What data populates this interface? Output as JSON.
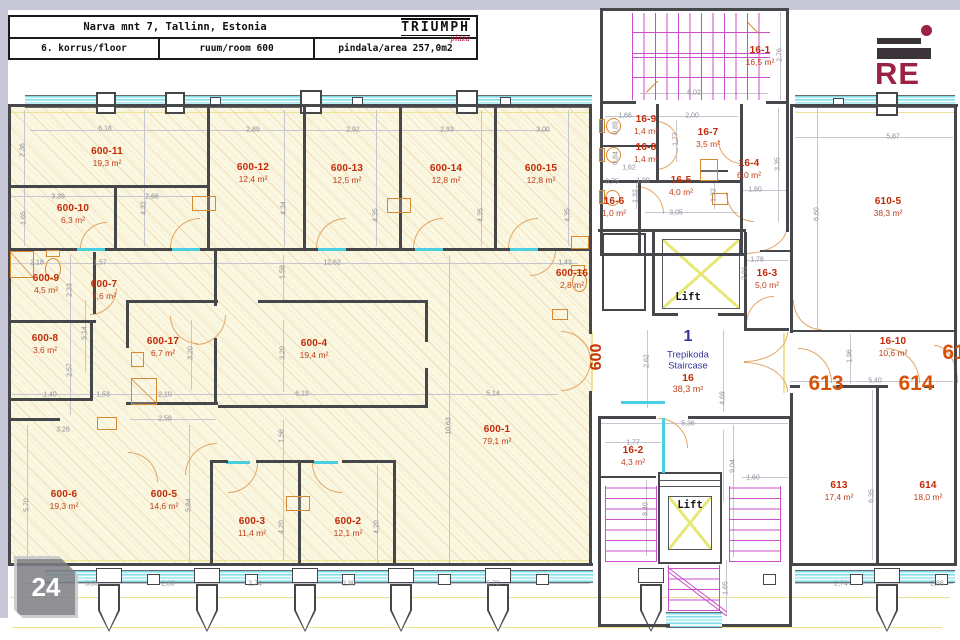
{
  "page": {
    "number": "24"
  },
  "title_block": {
    "address": "Narva mnt 7, Tallinn, Estonia",
    "floor": "6. korrus/floor",
    "room": "ruum/room 600",
    "area": "pindala/area 257,0m2",
    "brand_name": "TRIUMPH",
    "brand_sub": "plaza"
  },
  "logo": {
    "text": "RE"
  },
  "colors": {
    "room_label": "#c22a06",
    "room_area": "#bf3f1c",
    "door_label": "#d85207",
    "dimension": "#8d8d99",
    "stair_blue": "#34349c",
    "hatch_base": "#faf7e3",
    "window_cyan": "#7edde9",
    "stair_magenta": "#ca4fca",
    "lift_yellow": "#e7e776",
    "wall": "#45474b",
    "brand_red": "#c01a3c",
    "logo_maroon": "#9b2242"
  },
  "plan": {
    "lifts": [
      {
        "label": "Lift"
      },
      {
        "label": "Lift"
      }
    ],
    "staircase": {
      "number": "1",
      "name_et": "Trepikoda",
      "name_en": "Staircase",
      "room_no": "16",
      "room_area": "38,3 m²"
    },
    "door_labels": [
      {
        "text": "600"
      },
      {
        "text": "613"
      },
      {
        "text": "614"
      },
      {
        "text": "61"
      }
    ],
    "rooms": [
      {
        "id": "600-11",
        "area": "19,3 m²",
        "x": 107,
        "y": 157
      },
      {
        "id": "600-12",
        "area": "12,4 m²",
        "x": 253,
        "y": 173
      },
      {
        "id": "600-13",
        "area": "12,5 m²",
        "x": 347,
        "y": 174
      },
      {
        "id": "600-14",
        "area": "12,8 m²",
        "x": 446,
        "y": 174
      },
      {
        "id": "600-15",
        "area": "12,8 m²",
        "x": 541,
        "y": 174
      },
      {
        "id": "600-10",
        "area": "6,3 m²",
        "x": 73,
        "y": 214
      },
      {
        "id": "600-9",
        "area": "4,5 m²",
        "x": 46,
        "y": 284
      },
      {
        "id": "600-7",
        "area": "7,6 m²",
        "x": 104,
        "y": 290
      },
      {
        "id": "600-8",
        "area": "3,6 m²",
        "x": 45,
        "y": 344
      },
      {
        "id": "600-17",
        "area": "6,7 m²",
        "x": 163,
        "y": 347
      },
      {
        "id": "600-4",
        "area": "19,4 m²",
        "x": 314,
        "y": 349
      },
      {
        "id": "600-16",
        "area": "2,8 m²",
        "x": 572,
        "y": 279
      },
      {
        "id": "600-1",
        "area": "79,1 m²",
        "x": 497,
        "y": 435
      },
      {
        "id": "600-6",
        "area": "19,3 m²",
        "x": 64,
        "y": 500
      },
      {
        "id": "600-5",
        "area": "14,6 m²",
        "x": 164,
        "y": 500
      },
      {
        "id": "600-3",
        "area": "11,4 m²",
        "x": 252,
        "y": 527
      },
      {
        "id": "600-2",
        "area": "12,1 m²",
        "x": 348,
        "y": 527
      },
      {
        "id": "16-1",
        "area": "16,5 m²",
        "x": 760,
        "y": 56
      },
      {
        "id": "16-9",
        "area": "1,4 m²",
        "x": 646,
        "y": 125
      },
      {
        "id": "16-8",
        "area": "1,4 m²",
        "x": 646,
        "y": 153
      },
      {
        "id": "16-7",
        "area": "3,5 m²",
        "x": 708,
        "y": 138
      },
      {
        "id": "16-5",
        "area": "4,0 m²",
        "x": 681,
        "y": 186
      },
      {
        "id": "16-6",
        "area": "1,0 m²",
        "x": 614,
        "y": 207
      },
      {
        "id": "16-4",
        "area": "6,0 m²",
        "x": 749,
        "y": 169
      },
      {
        "id": "16-3",
        "area": "5,0 m²",
        "x": 767,
        "y": 279
      },
      {
        "id": "16-2",
        "area": "4,3 m²",
        "x": 633,
        "y": 456
      },
      {
        "id": "16-10",
        "area": "10,6 m²",
        "x": 893,
        "y": 347
      },
      {
        "id": "610-5",
        "area": "38,3 m²",
        "x": 888,
        "y": 207
      },
      {
        "id": "613",
        "area": "17,4 m²",
        "x": 839,
        "y": 491
      },
      {
        "id": "614",
        "area": "18,0 m²",
        "x": 928,
        "y": 491
      }
    ],
    "dims": [
      {
        "t": "6,18",
        "x": 105,
        "y": 129
      },
      {
        "t": "2,89",
        "x": 253,
        "y": 130
      },
      {
        "t": "2,92",
        "x": 353,
        "y": 130
      },
      {
        "t": "2,93",
        "x": 447,
        "y": 130
      },
      {
        "t": "3,00",
        "x": 543,
        "y": 130
      },
      {
        "t": "2,36",
        "x": 23,
        "y": 150,
        "v": 1
      },
      {
        "t": "4,32",
        "x": 144,
        "y": 208,
        "v": 1
      },
      {
        "t": "4,34",
        "x": 284,
        "y": 208,
        "v": 1
      },
      {
        "t": "4,35",
        "x": 376,
        "y": 215,
        "v": 1
      },
      {
        "t": "4,35",
        "x": 481,
        "y": 215,
        "v": 1
      },
      {
        "t": "4,35",
        "x": 568,
        "y": 215,
        "v": 1
      },
      {
        "t": "3,39",
        "x": 58,
        "y": 197
      },
      {
        "t": "2,68",
        "x": 152,
        "y": 197
      },
      {
        "t": "1,65",
        "x": 24,
        "y": 218,
        "v": 1
      },
      {
        "t": "2,18",
        "x": 37,
        "y": 263
      },
      {
        "t": "1,57",
        "x": 100,
        "y": 263
      },
      {
        "t": "12,62",
        "x": 332,
        "y": 263
      },
      {
        "t": "1,43",
        "x": 565,
        "y": 263
      },
      {
        "t": "1,58",
        "x": 283,
        "y": 272,
        "v": 1
      },
      {
        "t": "2,33",
        "x": 70,
        "y": 290,
        "v": 1
      },
      {
        "t": "5,14",
        "x": 85,
        "y": 333,
        "v": 1
      },
      {
        "t": "2,57",
        "x": 70,
        "y": 370,
        "v": 1
      },
      {
        "t": "3,20",
        "x": 191,
        "y": 353,
        "v": 1
      },
      {
        "t": "3,20",
        "x": 283,
        "y": 353,
        "v": 1
      },
      {
        "t": "1,40",
        "x": 50,
        "y": 395
      },
      {
        "t": "1,53",
        "x": 103,
        "y": 395
      },
      {
        "t": "2,10",
        "x": 165,
        "y": 395
      },
      {
        "t": "6,19",
        "x": 302,
        "y": 394
      },
      {
        "t": "5,14",
        "x": 493,
        "y": 394
      },
      {
        "t": "2,58",
        "x": 165,
        "y": 419
      },
      {
        "t": "3,28",
        "x": 63,
        "y": 430
      },
      {
        "t": "10,63",
        "x": 449,
        "y": 426,
        "v": 1
      },
      {
        "t": "1,56",
        "x": 282,
        "y": 436,
        "v": 1
      },
      {
        "t": "5,70",
        "x": 27,
        "y": 505,
        "v": 1
      },
      {
        "t": "5,84",
        "x": 189,
        "y": 505,
        "v": 1
      },
      {
        "t": "4,20",
        "x": 282,
        "y": 527,
        "v": 1
      },
      {
        "t": "4,20",
        "x": 377,
        "y": 527,
        "v": 1
      },
      {
        "t": "3,05",
        "x": 92,
        "y": 584
      },
      {
        "t": "2,88",
        "x": 168,
        "y": 584
      },
      {
        "t": "2,74",
        "x": 255,
        "y": 584
      },
      {
        "t": "2,90",
        "x": 349,
        "y": 584
      },
      {
        "t": "5,73",
        "x": 493,
        "y": 584
      },
      {
        "t": "2,74",
        "x": 841,
        "y": 584
      },
      {
        "t": "2,86",
        "x": 937,
        "y": 584
      },
      {
        "t": "6,02",
        "x": 694,
        "y": 93
      },
      {
        "t": "2,76",
        "x": 780,
        "y": 55,
        "v": 1
      },
      {
        "t": "1,66",
        "x": 625,
        "y": 116
      },
      {
        "t": "2,00",
        "x": 692,
        "y": 116
      },
      {
        "t": "1,77",
        "x": 676,
        "y": 139,
        "v": 1
      },
      {
        "t": "0,89",
        "x": 616,
        "y": 128,
        "v": 1
      },
      {
        "t": "0,84",
        "x": 616,
        "y": 158,
        "v": 1
      },
      {
        "t": "1,62",
        "x": 629,
        "y": 168
      },
      {
        "t": "0,75",
        "x": 612,
        "y": 182
      },
      {
        "t": "1,00",
        "x": 643,
        "y": 181
      },
      {
        "t": "1,32",
        "x": 636,
        "y": 196,
        "v": 1
      },
      {
        "t": "1,32",
        "x": 714,
        "y": 195,
        "v": 1
      },
      {
        "t": "3,05",
        "x": 676,
        "y": 213
      },
      {
        "t": "3,35",
        "x": 778,
        "y": 164,
        "v": 1
      },
      {
        "t": "1,80",
        "x": 755,
        "y": 190
      },
      {
        "t": "1,78",
        "x": 757,
        "y": 260
      },
      {
        "t": "2,91",
        "x": 745,
        "y": 273,
        "v": 1
      },
      {
        "t": "5,87",
        "x": 893,
        "y": 137
      },
      {
        "t": "6,60",
        "x": 817,
        "y": 214,
        "v": 1
      },
      {
        "t": "2,62",
        "x": 647,
        "y": 361,
        "v": 1
      },
      {
        "t": "4,69",
        "x": 723,
        "y": 398,
        "v": 1
      },
      {
        "t": "1,96",
        "x": 850,
        "y": 356,
        "v": 1
      },
      {
        "t": "5,40",
        "x": 875,
        "y": 381
      },
      {
        "t": "5,36",
        "x": 688,
        "y": 424
      },
      {
        "t": "1,77",
        "x": 633,
        "y": 443
      },
      {
        "t": "9,04",
        "x": 733,
        "y": 466,
        "v": 1
      },
      {
        "t": "1,60",
        "x": 753,
        "y": 478
      },
      {
        "t": "8,40",
        "x": 646,
        "y": 509,
        "v": 1
      },
      {
        "t": "6,35",
        "x": 872,
        "y": 496,
        "v": 1
      },
      {
        "t": "1,65",
        "x": 726,
        "y": 588,
        "v": 1
      }
    ]
  }
}
